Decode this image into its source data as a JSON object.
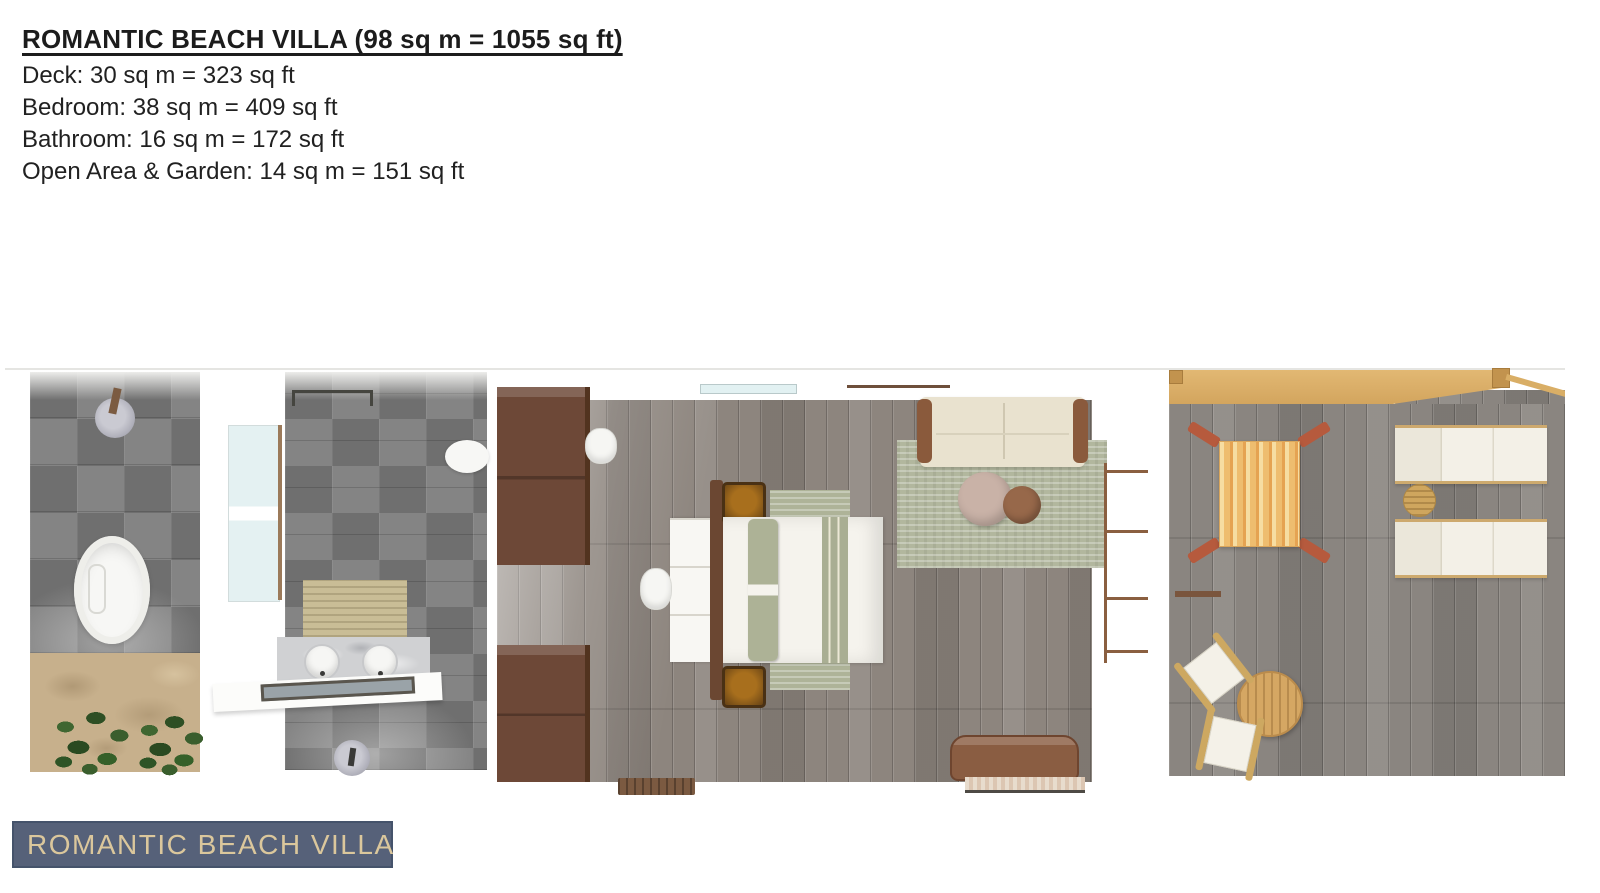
{
  "header": {
    "title": "ROMANTIC BEACH VILLA (98 sq m = 1055 sq ft)",
    "lines": [
      "Deck: 30 sq m = 323 sq ft",
      "Bedroom: 38 sq m = 409 sq ft",
      "Bathroom: 16 sq m = 172 sq ft",
      "Open Area & Garden: 14 sq m = 151 sq ft"
    ]
  },
  "badge": {
    "label": "ROMANTIC BEACH VILLA"
  },
  "palette": {
    "badge_background": "#566179",
    "badge_border": "#45536b",
    "badge_text": "#dbc79c",
    "title_text": "#1c1c1c",
    "tile_dark": "#6f6f6f",
    "tile_light": "#848484",
    "wood_floor": "#8d857e",
    "deck_floor": "#8a8580",
    "sand": "#c7b08c",
    "plant_green": "#2f5226",
    "cabinet_brown": "#6d4837",
    "sage_green": "#adb296",
    "sofa_cream": "#e9e2cf",
    "pergola_tan": "#dcb26b",
    "hammock_orange": "#eebd6f",
    "teak_wood": "#d0a561",
    "lounger_white": "#f2efe6",
    "marble": "#d0d1d3"
  }
}
